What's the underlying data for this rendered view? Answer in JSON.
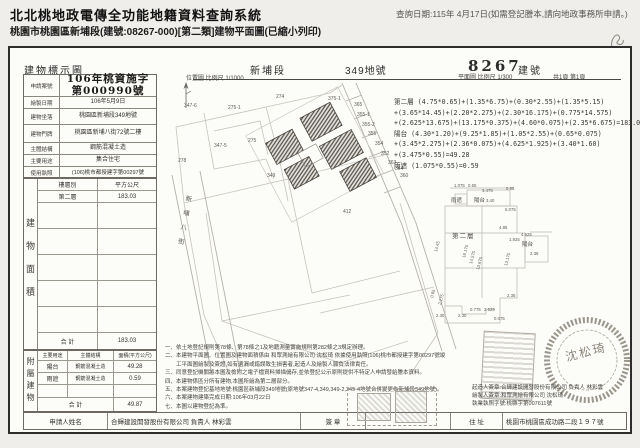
{
  "page": {
    "system_title": "北北桃地政電傳全功能地籍資料查詢系統",
    "query_date": "查詢日期:115年 4月17日(如需登記謄本,請向地政事務所申請。)",
    "doc_line": "桃園市桃園區新埔段(建號:08267-000)[第二類]建物平面圖(已縮小列印)"
  },
  "doc_header": {
    "title": "建物標示圖",
    "section": "新埔段",
    "land_no": "349地號",
    "building_no": "8267",
    "building_no_label": "建號",
    "site_scale": "位置圖 比例尺 1/1000",
    "plan_scale": "平面圖 比例尺 1/300",
    "pages": "共1頁 第1頁"
  },
  "meta": {
    "case_label": "申請案號",
    "case_line1": "106年桃資施字",
    "case_line2": "第000990號",
    "rows": [
      {
        "label": "繪製日期",
        "value": "106年5月9日"
      },
      {
        "label": "建物坐落",
        "value": "桃園區新埔段349地號"
      },
      {
        "label": "建物門牌",
        "value": "桃園區新埔八街72號二樓"
      },
      {
        "label": "主體結構",
        "value": "鋼筋混凝土造"
      },
      {
        "label": "主要用途",
        "value": "集合住宅"
      },
      {
        "label": "使用執照",
        "value": "(106)桃市都授建字第00297號"
      }
    ]
  },
  "floor_table": {
    "vertical_label": "建物面積",
    "col_floor": "樓層別",
    "col_area": "平方公尺",
    "rows": [
      {
        "floor": "第二層",
        "area": "183.03"
      },
      {
        "floor": "",
        "area": ""
      },
      {
        "floor": "",
        "area": ""
      },
      {
        "floor": "",
        "area": ""
      },
      {
        "floor": "",
        "area": ""
      },
      {
        "floor": "",
        "area": ""
      }
    ],
    "total_label": "合  計",
    "total": "183.03"
  },
  "attached_table": {
    "vertical_label": "附屬建物",
    "col_use": "主要用途",
    "col_structure": "主體結構",
    "col_area": "面積(平方公尺)",
    "rows": [
      {
        "use": "陽台",
        "structure": "鋼筋混凝土造",
        "area": "49.28"
      },
      {
        "use": "雨遮",
        "structure": "鋼筋混凝土造",
        "area": "0.59"
      }
    ],
    "total_label": "合  計",
    "total": "49.87"
  },
  "formulas": {
    "lines": [
      "第二層 (4.75*0.65)+(1.35*6.75)+(0.30*2.55)+(1.35*5.15)",
      "+(3.65*14.45)+(2.20*2.275)+(2.30*16.175)+(0.775*14.575)",
      "+(2.625*13.675)+(13.175*0.375)+(4.60*0.075)+(2.35*6.675)=183.03",
      "陽台 (4.30*1.20)+(9.25*1.85)+(1.05*2.55)+(0.65*0.075)",
      "+(3.45*2.275)+(2.36*0.075)+(4.625*1.925)+(3.40*1.60)",
      "+(3.475*0.55)=49.28",
      "雨遮 (1.075*0.55)=0.59"
    ]
  },
  "notes": {
    "lines": [
      "一、依土地登記規則第78條、第78條之1及地籍測量實施規則第282條之3規定辦理。",
      "二、本建物平面圖、位置圖及建物面積係由 和眾測繪有限公司 沈松琦 依據使用執照(106)桃市都授建字第00297號竣",
      "　　工平面圖繪製及簽證,如有遺漏或錯誤致生損害者,起造人及繪製人願負法律責任。",
      "三、同意登記機關將本圖及檢附之電子檔資料掃描儲存,並依登記公示原則提供不特定人申請發給謄本資料。",
      "四、本建物係區分所有建物,本圖所繪為第二層部分。",
      "五、本案建物登記基地地號:桃園區新埔段349地號(原地號347-4,349,349-2,349-4地號合併變更為新埔段349地號)。",
      "六、本案建物建築完成日期:106年03月22日",
      "七、本圖以建物登記為準。"
    ]
  },
  "signers": {
    "lines": [
      "起造人簽章:合輝建設開發股份有限公司 負責人 林彩雲",
      "繪製人簽章:和眾測繪有限公司 沈松琦",
      "執業執照字號:桃縣字第007611號"
    ]
  },
  "applicant": {
    "name_label": "申請人姓名",
    "name": "合輝建設開發股份有限公司 負責人 林彩雲",
    "sign_label": "簽  章",
    "address_label": "住  址",
    "address": "桃園市桃園區成功路二段１９７號"
  },
  "site_plan": {
    "street": "新埔八街",
    "parcels": [
      "347-6",
      "275-1",
      "274",
      "375-1",
      "365",
      "355-1",
      "355-2",
      "355",
      "354",
      "352",
      "363",
      "364",
      "360",
      "347-5",
      "275",
      "278",
      "349",
      "412"
    ]
  },
  "floor_plan": {
    "labels": {
      "floor": "第二層",
      "balcony_top": "陽台",
      "balcony_right": "陽台",
      "canopy": "雨遮"
    },
    "dims": [
      "1.075",
      "0.55",
      "3.475",
      "3.40",
      "0.55",
      "5.075",
      "4.85",
      "14.45",
      "16.175",
      "14.575",
      "13.675",
      "13.175",
      "1.925",
      "4.625",
      "2.36",
      "2.35",
      "2.30",
      "2.30",
      "0.775",
      "2.625",
      "0.075",
      "2.275",
      "0.65"
    ]
  },
  "seal": {
    "surveyor": "沈松琦"
  },
  "colors": {
    "ink": "#2b2b2b",
    "line": "#8a877f",
    "faint": "#bdbab3"
  }
}
